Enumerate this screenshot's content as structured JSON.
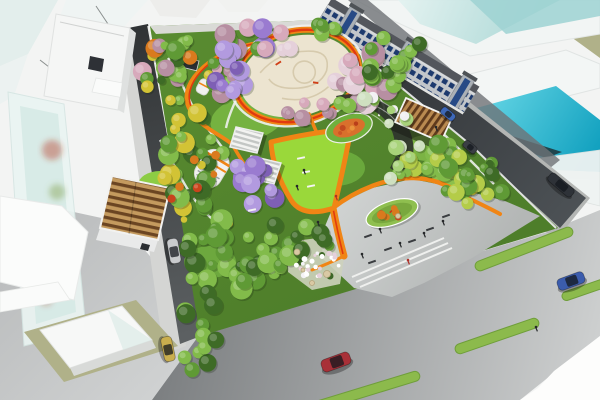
{
  "meta": {
    "description": "Aerial perspective rendering of an urban pocket park masterplan with orange looping paths, a cream central plaza, wisteria tunnel, blossom and evergreen trees, pergolas, a grey event plaza, surrounding streets with cars, green medians, glass towers and a shophouse row"
  },
  "palette": {
    "park_base": "#55862e",
    "lawn_bright": "#9ad83a",
    "plaza_cream": "#ece4d0",
    "plaza_grey": "#c7cac9",
    "path_orange": "#f08515",
    "path_red": "#e03a10",
    "olive": "#b0b189",
    "flowerbed_ring": "#6fb03c",
    "flowerbed_fill": "#d9702c",
    "median_green": "#8cba4c",
    "glass_cyan": "#28b6cf",
    "glass_teal": "#bfe2e0",
    "asphalt_dark": "#35383a",
    "boulevard_grey": "#9a9da0",
    "shophouse_window_blue": "#1d3a6e",
    "wisteria_purple": "#9a7bd0",
    "blossom_pink": "#d7a9bb"
  },
  "scene": {
    "tree_clusters": [
      {
        "name": "nw-mixed",
        "cx": 192,
        "cy": 72,
        "rx": 50,
        "ry": 36,
        "n": 30,
        "rmin": 4,
        "rmax": 10,
        "colors": [
          "#5f9a35",
          "#d7a9bb",
          "#b78fa2",
          "#d97a1e",
          "#3e6b26",
          "#d2c335",
          "#82bb4a"
        ]
      },
      {
        "name": "north-blossom",
        "cx": 258,
        "cy": 42,
        "rx": 40,
        "ry": 16,
        "n": 12,
        "rmin": 6,
        "rmax": 11,
        "colors": [
          "#d7a9bb",
          "#b78fa2",
          "#e5d0da",
          "#9a7bd0",
          "#5f9a35"
        ]
      },
      {
        "name": "west-forest",
        "cx": 190,
        "cy": 163,
        "rx": 36,
        "ry": 52,
        "n": 26,
        "rmin": 5,
        "rmax": 11,
        "colors": [
          "#5f9a35",
          "#3e6b26",
          "#82bb4a",
          "#d2c335"
        ]
      },
      {
        "name": "west-autumn",
        "cx": 204,
        "cy": 196,
        "rx": 33,
        "ry": 44,
        "n": 9,
        "rmin": 3,
        "rmax": 5,
        "colors": [
          "#d97a1e",
          "#c8441c",
          "#d2c335"
        ]
      },
      {
        "name": "sw-forest",
        "cx": 228,
        "cy": 258,
        "rx": 50,
        "ry": 40,
        "n": 28,
        "rmin": 5,
        "rmax": 12,
        "colors": [
          "#5f9a35",
          "#3e6b26",
          "#82bb4a"
        ]
      },
      {
        "name": "plaza-east-blossom",
        "cx": 362,
        "cy": 78,
        "rx": 28,
        "ry": 33,
        "n": 13,
        "rmin": 7,
        "rmax": 12,
        "colors": [
          "#d7a9bb",
          "#b78fa2",
          "#e5d0da"
        ]
      },
      {
        "name": "plaza-south-blossom",
        "cx": 302,
        "cy": 112,
        "rx": 30,
        "ry": 12,
        "n": 8,
        "rmin": 5,
        "rmax": 9,
        "colors": [
          "#b78fa2",
          "#d7a9bb"
        ]
      },
      {
        "name": "ne-grove",
        "cx": 396,
        "cy": 60,
        "rx": 32,
        "ry": 26,
        "n": 15,
        "rmin": 5,
        "rmax": 10,
        "colors": [
          "#5f9a35",
          "#82bb4a",
          "#3e6b26"
        ]
      },
      {
        "name": "east-grove",
        "cx": 430,
        "cy": 156,
        "rx": 31,
        "ry": 24,
        "n": 14,
        "rmin": 5,
        "rmax": 10,
        "colors": [
          "#b4cc48",
          "#82bb4a",
          "#5f9a35"
        ]
      },
      {
        "name": "se-grove",
        "cx": 467,
        "cy": 192,
        "rx": 36,
        "ry": 15,
        "n": 11,
        "rmin": 5,
        "rmax": 9,
        "colors": [
          "#5f9a35",
          "#b4cc48",
          "#d2c335"
        ]
      },
      {
        "name": "south-grove",
        "cx": 290,
        "cy": 247,
        "rx": 40,
        "ry": 24,
        "n": 16,
        "rmin": 5,
        "rmax": 11,
        "colors": [
          "#5f9a35",
          "#3e6b26",
          "#82bb4a"
        ]
      },
      {
        "name": "street-grove",
        "cx": 200,
        "cy": 328,
        "rx": 20,
        "ry": 50,
        "n": 11,
        "rmin": 6,
        "rmax": 10,
        "colors": [
          "#5f9a35",
          "#82bb4a",
          "#3e6b26"
        ]
      },
      {
        "name": "wisteria-upper",
        "cx": 232,
        "cy": 72,
        "rx": 18,
        "ry": 27,
        "n": 10,
        "rmin": 6,
        "rmax": 10,
        "colors": [
          "#9a7bd0",
          "#b29adf",
          "#7e5fb5"
        ]
      },
      {
        "name": "wisteria-lower",
        "cx": 256,
        "cy": 182,
        "rx": 24,
        "ry": 29,
        "n": 12,
        "rmin": 6,
        "rmax": 11,
        "colors": [
          "#9a7bd0",
          "#b29adf",
          "#7e5fb5"
        ]
      },
      {
        "name": "gallery-foliage-a",
        "cx": 358,
        "cy": 100,
        "rx": 19,
        "ry": 11,
        "n": 6,
        "rmin": 4,
        "rmax": 8,
        "colors": [
          "#cfe0c0",
          "#82bb4a",
          "#f2f1f4"
        ]
      },
      {
        "name": "gallery-foliage-b",
        "cx": 392,
        "cy": 120,
        "rx": 15,
        "ry": 11,
        "n": 6,
        "rmin": 4,
        "rmax": 8,
        "colors": [
          "#cfe0c0",
          "#f2f1f4",
          "#a8d37a"
        ]
      },
      {
        "name": "gallery-foliage-c",
        "cx": 408,
        "cy": 148,
        "rx": 13,
        "ry": 11,
        "n": 5,
        "rmin": 4,
        "rmax": 8,
        "colors": [
          "#cfe0c0",
          "#a8d37a",
          "#f2f1f4"
        ]
      },
      {
        "name": "gallery-foliage-d",
        "cx": 397,
        "cy": 172,
        "rx": 15,
        "ry": 9,
        "n": 5,
        "rmin": 4,
        "rmax": 7,
        "colors": [
          "#cfe0c0",
          "#82bb4a",
          "#a8d37a"
        ]
      },
      {
        "name": "white-flower-garden",
        "cx": 315,
        "cy": 263,
        "rx": 25,
        "ry": 14,
        "n": 26,
        "rmin": 1.5,
        "rmax": 3,
        "colors": [
          "#f4f3f6",
          "#ffffff",
          "#e5d0da"
        ]
      },
      {
        "name": "island-shrubs",
        "cx": 392,
        "cy": 213,
        "rx": 12,
        "ry": 5,
        "n": 8,
        "rmin": 2.5,
        "rmax": 4.5,
        "colors": [
          "#d97a1e",
          "#c8441c",
          "#b4cc48"
        ]
      },
      {
        "name": "north-corner-grove",
        "cx": 328,
        "cy": 30,
        "rx": 16,
        "ry": 9,
        "n": 6,
        "rmin": 4,
        "rmax": 8,
        "colors": [
          "#5f9a35",
          "#82bb4a"
        ]
      },
      {
        "name": "east-edge-grove",
        "cx": 478,
        "cy": 163,
        "rx": 20,
        "ry": 18,
        "n": 8,
        "rmin": 4,
        "rmax": 8,
        "colors": [
          "#5f9a35",
          "#3e6b26"
        ]
      }
    ],
    "cars": [
      {
        "name": "car-silver",
        "x": 174,
        "y": 251,
        "angle": 80,
        "len": 25,
        "wid": 11,
        "color": "#c9cbcd"
      },
      {
        "name": "car-gold",
        "x": 168,
        "y": 349,
        "angle": 78,
        "len": 25,
        "wid": 11,
        "color": "#c9ae4e"
      },
      {
        "name": "car-red",
        "x": 336,
        "y": 362,
        "angle": -20,
        "len": 30,
        "wid": 13,
        "color": "#a83038"
      },
      {
        "name": "car-blue",
        "x": 571,
        "y": 281,
        "angle": -20,
        "len": 28,
        "wid": 12,
        "color": "#3b5cad"
      },
      {
        "name": "car-blue-small",
        "x": 448,
        "y": 114,
        "angle": 40,
        "len": 16,
        "wid": 8,
        "color": "#3e68b8"
      },
      {
        "name": "car-dark",
        "x": 470,
        "y": 147,
        "angle": 40,
        "len": 15,
        "wid": 8,
        "color": "#3a3e44"
      },
      {
        "name": "bus-dark",
        "x": 561,
        "y": 185,
        "angle": 40,
        "len": 30,
        "wid": 10,
        "color": "#2e3238"
      }
    ],
    "medians": [
      {
        "cx": 497,
        "cy": 336,
        "len": 88,
        "w": 10,
        "angle": -19
      },
      {
        "cx": 524,
        "cy": 249,
        "len": 104,
        "w": 10,
        "angle": -21
      },
      {
        "cx": 584,
        "cy": 290,
        "len": 46,
        "w": 9,
        "angle": -19
      },
      {
        "cx": 367,
        "cy": 391,
        "len": 110,
        "w": 10,
        "angle": -17
      }
    ],
    "median_fill": "#8cba4c",
    "median_stroke": "#6f9e3a",
    "people": [
      {
        "x": 380,
        "y": 229,
        "c": "#26282a"
      },
      {
        "x": 400,
        "y": 243,
        "c": "#26282a"
      },
      {
        "x": 424,
        "y": 233,
        "c": "#26282a"
      },
      {
        "x": 362,
        "y": 254,
        "c": "#26282a"
      },
      {
        "x": 443,
        "y": 221,
        "c": "#26282a"
      },
      {
        "x": 408,
        "y": 260,
        "c": "#b03028"
      },
      {
        "x": 318,
        "y": 222,
        "c": "#26282a"
      },
      {
        "x": 336,
        "y": 196,
        "c": "#b03028"
      },
      {
        "x": 304,
        "y": 170,
        "c": "#26282a"
      },
      {
        "x": 297,
        "y": 186,
        "c": "#26282a"
      },
      {
        "x": 536,
        "y": 327,
        "c": "#26282a"
      },
      {
        "x": 436,
        "y": 127,
        "c": "#26282a"
      }
    ],
    "benches": [
      {
        "x": 368,
        "y": 236,
        "a": -20,
        "c": "#3a3d40"
      },
      {
        "x": 388,
        "y": 249,
        "a": -20,
        "c": "#3a3d40"
      },
      {
        "x": 412,
        "y": 241,
        "a": -20,
        "c": "#3a3d40"
      },
      {
        "x": 430,
        "y": 229,
        "a": -20,
        "c": "#3a3d40"
      },
      {
        "x": 372,
        "y": 262,
        "a": -20,
        "c": "#3a3d40"
      },
      {
        "x": 446,
        "y": 216,
        "a": -20,
        "c": "#3a3d40"
      },
      {
        "x": 301,
        "y": 158,
        "a": -12,
        "c": "#f4f4f2"
      },
      {
        "x": 306,
        "y": 172,
        "a": -12,
        "c": "#f4f4f2"
      },
      {
        "x": 311,
        "y": 186,
        "a": -12,
        "c": "#f4f4f2"
      },
      {
        "x": 252,
        "y": 210,
        "a": -12,
        "c": "#f4f4f2"
      }
    ],
    "rocks": [
      {
        "x": 297,
        "y": 252,
        "r": 3
      },
      {
        "x": 327,
        "y": 274,
        "r": 3.5
      },
      {
        "x": 312,
        "y": 283,
        "r": 2.5
      },
      {
        "x": 398,
        "y": 216,
        "r": 2.5
      },
      {
        "x": 303,
        "y": 270,
        "r": 2
      }
    ],
    "rock_fill": "#d9c9a4",
    "rock_stroke": "#b5a47c"
  }
}
